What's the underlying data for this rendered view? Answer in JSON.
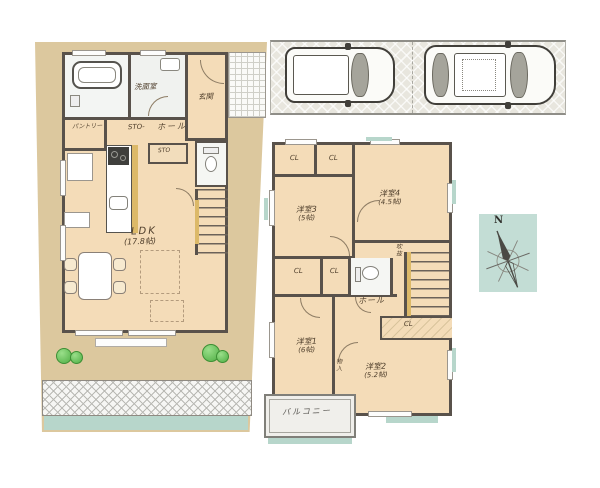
{
  "floor1": {
    "rooms": {
      "washroom": "洗面室",
      "entrance": "玄関",
      "pantry": "パントリー",
      "storage_top": "STO-",
      "hall": "ホール",
      "storage_small": "STO",
      "ldk": "LDK",
      "ldk_size": "(17.8帖)"
    }
  },
  "floor2": {
    "rooms": {
      "room3": "洋室3",
      "room3_size": "(5帖)",
      "room4": "洋室4",
      "room4_size": "(4.5帖)",
      "room1": "洋室1",
      "room1_size": "(6帖)",
      "room2": "洋室2",
      "room2_size": "(5.2帖)",
      "hall": "ホール",
      "void": "吹抜",
      "storage": "物入",
      "balcony": "バルコニー"
    },
    "closets": [
      "CL",
      "CL",
      "CL",
      "CL",
      "CL"
    ]
  },
  "compass": {
    "north": "N"
  },
  "colors": {
    "site": "#dcc89e",
    "room_floor": "#f4dcb8",
    "wall": "#59524b",
    "teal_accent": "#b7d6cb",
    "paving": "#e8e6de",
    "bush_green": "#4fae44",
    "stair_rail": "#dcb968"
  }
}
